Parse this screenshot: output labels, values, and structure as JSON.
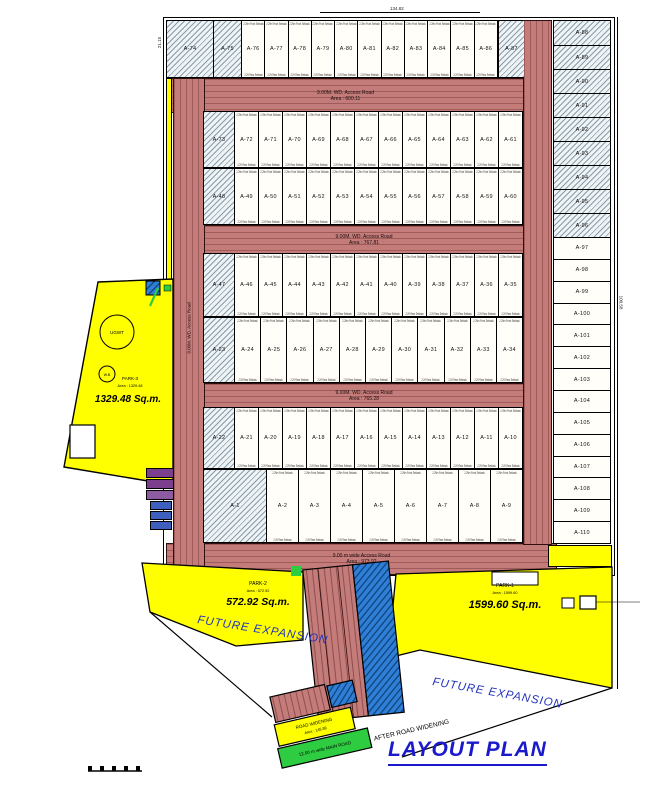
{
  "title": "LAYOUT PLAN",
  "annotations": {
    "future_expansion_left": "FUTURE EXPANSION",
    "future_expansion_right": "FUTURE EXPANSION",
    "after_widening": "AFTER ROAD WIDENING"
  },
  "parks": {
    "park3": {
      "name": "PARK-3",
      "area_note": "Area : 1329.48",
      "area": "1329.48 Sq.m."
    },
    "park2": {
      "name": "PARK-2",
      "area_note": "Area : 572.92",
      "area": "572.92 Sq.m."
    },
    "park1": {
      "name": "PARK-1",
      "area_note": "Area : 1599.60",
      "area": "1599.60 Sq.m."
    }
  },
  "roads": {
    "access1": {
      "name": "9.00M. WD. Access Road",
      "area": "Area : 600.11"
    },
    "access2": {
      "name": "9.00M. WD. Access Road",
      "area": "Area : 767.81"
    },
    "access3": {
      "name": "9.00M. WD. Access Road",
      "area": "Area : 765.28"
    },
    "access4": {
      "name": "9.00 m wide Access Road",
      "area": "Area : 973.92"
    },
    "left_vertical": "9.00M. WD. Access Road",
    "widening": {
      "name": "ROAD WIDENING",
      "area": "Area : 145.86"
    },
    "main_road": "12.00 m wide MAIN ROAD"
  },
  "plot_notes": {
    "front": "2.29m Front Setback",
    "rear": "2.29 Rear Setback"
  },
  "tank_label": "UGWT",
  "well_label": "W.B",
  "dimensions": {
    "top": "134.82",
    "right": "100.58",
    "left": "21.15"
  },
  "bands": {
    "top": {
      "hatched": [
        "A-74",
        "A-75"
      ],
      "open": [
        "A-76",
        "A-77",
        "A-78",
        "A-79",
        "A-80",
        "A-81",
        "A-82",
        "A-83",
        "A-84",
        "A-85",
        "A-86"
      ]
    },
    "corner": {
      "hatched": [
        "A-87"
      ],
      "open": []
    },
    "row2_upper": {
      "hatched": [
        "A-73"
      ],
      "open": [
        "A-72",
        "A-71",
        "A-70",
        "A-69",
        "A-68",
        "A-67",
        "A-66",
        "A-65",
        "A-64",
        "A-63",
        "A-62",
        "A-61"
      ]
    },
    "row2_lower": {
      "hatched": [
        "A-48"
      ],
      "open": [
        "A-49",
        "A-50",
        "A-51",
        "A-52",
        "A-53",
        "A-54",
        "A-55",
        "A-56",
        "A-57",
        "A-58",
        "A-59",
        "A-60"
      ]
    },
    "row3": {
      "hatched": [
        "A-47"
      ],
      "open": [
        "A-46",
        "A-45",
        "A-44",
        "A-43",
        "A-42",
        "A-41",
        "A-40",
        "A-39",
        "A-38",
        "A-37",
        "A-36",
        "A-35"
      ]
    },
    "row4": {
      "hatched": [
        "A-23"
      ],
      "open": [
        "A-24",
        "A-25",
        "A-26",
        "A-27",
        "A-28",
        "A-29",
        "A-30",
        "A-31",
        "A-32",
        "A-33",
        "A-34"
      ]
    },
    "row5": {
      "hatched": [
        "A-22"
      ],
      "open": [
        "A-21",
        "A-20",
        "A-19",
        "A-18",
        "A-17",
        "A-16",
        "A-15",
        "A-14",
        "A-13",
        "A-12",
        "A-11",
        "A-10"
      ]
    },
    "row6": {
      "hatched": [
        "A-1"
      ],
      "open": [
        "A-2",
        "A-3",
        "A-4",
        "A-5",
        "A-6",
        "A-7",
        "A-8",
        "A-9"
      ]
    },
    "right_hatched": [
      "A-88",
      "A-89",
      "A-90",
      "A-91",
      "A-92",
      "A-93",
      "A-94",
      "A-95",
      "A-96"
    ],
    "right_open": [
      "A-97",
      "A-98",
      "A-99",
      "A-100",
      "A-101",
      "A-102",
      "A-103",
      "A-104",
      "A-105",
      "A-106",
      "A-107",
      "A-108",
      "A-109",
      "A-110"
    ]
  },
  "colors": {
    "road": "#c47c7a",
    "road_stripe": "#9e5957",
    "park_yellow": "#ffff00",
    "hatch_bg": "#eef3f5",
    "widening_blue": "#2f7fd6",
    "main_road_green": "#2ecc40",
    "title_blue": "#1a1acc",
    "annotation_blue": "#2233bb",
    "purple": "#7b3f8e"
  }
}
